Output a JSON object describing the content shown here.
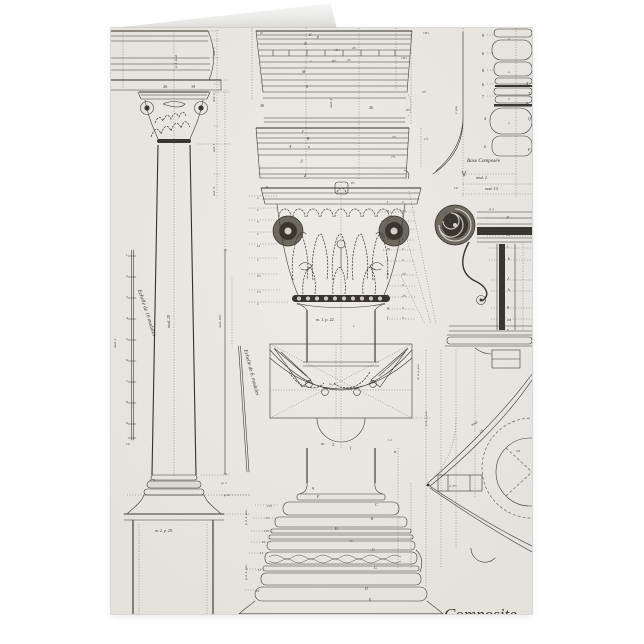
{
  "page": {
    "background": "#ffffff"
  },
  "card": {
    "paper_color": "#e9e7e2",
    "ink_color": "#3e3b33",
    "caption_partial": "Composite",
    "subject": "Composite order engraving plate"
  },
  "engraving": {
    "scale_left": {
      "x": 15,
      "y0": 228,
      "dy": 21,
      "labels": [
        "1",
        "2",
        "3",
        "4",
        "5",
        "6",
        "7",
        "8",
        "9",
        "10"
      ]
    },
    "capital_dim_table": {
      "letter_x": 276,
      "value_x": 291,
      "ys": [
        175,
        184,
        193,
        201,
        212,
        222,
        233,
        247,
        258,
        269,
        281,
        291
      ],
      "rows": [
        [
          "r",
          "2"
        ],
        [
          "q",
          "2½"
        ],
        [
          "p",
          "2"
        ],
        [
          "o",
          "2"
        ],
        [
          "n",
          "2"
        ],
        [
          "m",
          "2"
        ],
        [
          "l",
          "2"
        ],
        [
          "k",
          "2½"
        ],
        [
          "J",
          "2"
        ],
        [
          "h",
          "2½"
        ],
        [
          "g",
          "⅓"
        ],
        [
          "f",
          "½"
        ]
      ]
    },
    "texts": [
      {
        "x": 52,
        "y": 60,
        "t": "26",
        "s": 4.2
      },
      {
        "x": 80,
        "y": 60,
        "t": "19",
        "s": 4.2
      },
      {
        "x": 66,
        "y": 40,
        "t": "p. 4. mod.",
        "r": -90,
        "s": 3.4,
        "i": 1
      },
      {
        "x": 59,
        "y": 300,
        "t": "mod. 20",
        "r": -90,
        "s": 4,
        "i": 1
      },
      {
        "x": 5,
        "y": 320,
        "t": "mod. 2.",
        "r": -90,
        "s": 3.4,
        "i": 1
      },
      {
        "x": 110,
        "y": 300,
        "t": "mod. 16½",
        "r": -90,
        "s": 3.4,
        "i": 1
      },
      {
        "x": 27,
        "y": 262,
        "t": "Echelle de 10 modules",
        "r": 72,
        "s": 5.4,
        "i": 1
      },
      {
        "x": 133,
        "y": 322,
        "t": "Echelle de 6. modules",
        "r": 75,
        "s": 5.4,
        "i": 1
      },
      {
        "x": 104,
        "y": 28,
        "t": "mod. ½",
        "r": -90,
        "s": 3,
        "i": 1
      },
      {
        "x": 104,
        "y": 74,
        "t": "mod. ⅓",
        "r": -90,
        "s": 3,
        "i": 1
      },
      {
        "x": 104,
        "y": 124,
        "t": "mod. 1.",
        "r": -90,
        "s": 3,
        "i": 1
      },
      {
        "x": 104,
        "y": 168,
        "t": "mod. ⅙",
        "r": -90,
        "s": 3,
        "i": 1
      },
      {
        "x": 38,
        "y": 453,
        "t": "m. 3",
        "s": 3.4,
        "i": 1
      },
      {
        "x": 44,
        "y": 504,
        "t": "m. 2. p. 29.",
        "s": 4,
        "i": 1
      },
      {
        "x": 110,
        "y": 456,
        "t": "m. 1",
        "s": 3.4,
        "i": 1
      },
      {
        "x": 113,
        "y": 468,
        "t": "p. 3.",
        "s": 3.4,
        "i": 1
      },
      {
        "x": 136,
        "y": 497,
        "t": "p. d. 4. pou.",
        "r": -90,
        "s": 3.3,
        "i": 1
      },
      {
        "x": 136,
        "y": 552,
        "t": "g. d. 4. pou.",
        "r": -90,
        "s": 3.3,
        "i": 1
      },
      {
        "x": 149,
        "y": 6,
        "t": "10",
        "s": 3
      },
      {
        "x": 198,
        "y": 8,
        "t": "C",
        "s": 4,
        "i": 1
      },
      {
        "x": 206,
        "y": 10,
        "t": "p",
        "s": 4,
        "i": 1
      },
      {
        "x": 193,
        "y": 17,
        "t": "N",
        "s": 3.8,
        "i": 1
      },
      {
        "x": 223,
        "y": 23,
        "t": "12½",
        "s": 3.4
      },
      {
        "x": 241,
        "y": 21,
        "t": "20",
        "s": 3.4
      },
      {
        "x": 199,
        "y": 34,
        "t": "1",
        "s": 3.4
      },
      {
        "x": 221,
        "y": 34,
        "t": "8½",
        "s": 3.4
      },
      {
        "x": 236,
        "y": 33,
        "t": "23",
        "s": 3.4
      },
      {
        "x": 290,
        "y": 31,
        "t": "14½",
        "s": 3.4
      },
      {
        "x": 312,
        "y": 6,
        "t": "10½",
        "s": 3.4
      },
      {
        "x": 191,
        "y": 45,
        "t": "M",
        "s": 3.8,
        "i": 1
      },
      {
        "x": 195,
        "y": 60,
        "t": "S",
        "s": 4,
        "i": 1
      },
      {
        "x": 149,
        "y": 79,
        "t": "30",
        "s": 4
      },
      {
        "x": 221,
        "y": 80,
        "t": "mod. 4",
        "r": -90,
        "s": 3.4,
        "i": 1
      },
      {
        "x": 258,
        "y": 81,
        "t": "26",
        "s": 4
      },
      {
        "x": 295,
        "y": 83,
        "t": "8½",
        "s": 3.4
      },
      {
        "x": 311,
        "y": 65,
        "t": "2½",
        "s": 3.4
      },
      {
        "x": 191,
        "y": 104,
        "t": "y",
        "s": 4,
        "i": 1
      },
      {
        "x": 196,
        "y": 112,
        "t": "B",
        "s": 3.6,
        "i": 1
      },
      {
        "x": 197,
        "y": 120,
        "t": "u",
        "s": 3.6,
        "i": 1
      },
      {
        "x": 178,
        "y": 120,
        "t": "X",
        "s": 4,
        "i": 1
      },
      {
        "x": 190,
        "y": 134,
        "t": "y",
        "s": 5,
        "i": 1
      },
      {
        "x": 193,
        "y": 149,
        "t": "Z",
        "s": 4,
        "i": 1
      },
      {
        "x": 281,
        "y": 110,
        "t": "2½",
        "s": 3.4
      },
      {
        "x": 280,
        "y": 130,
        "t": "7½",
        "s": 3.4
      },
      {
        "x": 313,
        "y": 112,
        "t": "1½",
        "s": 3.4
      },
      {
        "x": 146,
        "y": 171,
        "t": "2",
        "s": 3
      },
      {
        "x": 146,
        "y": 183,
        "t": "2",
        "s": 3
      },
      {
        "x": 146,
        "y": 195,
        "t": "3",
        "s": 3
      },
      {
        "x": 146,
        "y": 207,
        "t": "2",
        "s": 3
      },
      {
        "x": 146,
        "y": 219,
        "t": "12",
        "s": 3
      },
      {
        "x": 146,
        "y": 233,
        "t": "2",
        "s": 3
      },
      {
        "x": 146,
        "y": 249,
        "t": "2½",
        "s": 3
      },
      {
        "x": 146,
        "y": 265,
        "t": "1½",
        "s": 3
      },
      {
        "x": 146,
        "y": 277,
        "t": "2",
        "s": 3
      },
      {
        "x": 155,
        "y": 160,
        "t": "u",
        "s": 4,
        "i": 1
      },
      {
        "x": 240,
        "y": 156,
        "t": "9½",
        "s": 3
      },
      {
        "x": 205,
        "y": 293,
        "t": "m. 1.  p. 22.",
        "s": 4.2,
        "i": 1
      },
      {
        "x": 242,
        "y": 299,
        "t": "e",
        "s": 3.4,
        "i": 1
      },
      {
        "x": 218,
        "y": 357,
        "t": "m. 2",
        "s": 3.4,
        "i": 1
      },
      {
        "x": 210,
        "y": 417,
        "t": "m.",
        "s": 4,
        "i": 1
      },
      {
        "x": 221,
        "y": 418,
        "t": "2.",
        "s": 4
      },
      {
        "x": 239,
        "y": 421,
        "t": "f",
        "s": 4,
        "i": 1
      },
      {
        "x": 277,
        "y": 413,
        "t": "1 2",
        "s": 3
      },
      {
        "x": 283,
        "y": 425,
        "t": "B",
        "s": 3.4,
        "i": 1
      },
      {
        "x": 201,
        "y": 461,
        "t": "q",
        "s": 4,
        "i": 1
      },
      {
        "x": 206,
        "y": 470,
        "t": "F",
        "s": 4,
        "i": 1
      },
      {
        "x": 264,
        "y": 478,
        "t": "C",
        "s": 3.8,
        "i": 1
      },
      {
        "x": 260,
        "y": 492,
        "t": "B",
        "s": 3.6,
        "i": 1
      },
      {
        "x": 224,
        "y": 502,
        "t": "H",
        "s": 3.8,
        "i": 1
      },
      {
        "x": 238,
        "y": 514,
        "t": "13",
        "s": 3.4
      },
      {
        "x": 261,
        "y": 523,
        "t": "G",
        "s": 3.8,
        "i": 1
      },
      {
        "x": 263,
        "y": 541,
        "t": "G",
        "s": 3.8,
        "i": 1
      },
      {
        "x": 254,
        "y": 562,
        "t": "D",
        "s": 3.8,
        "i": 1
      },
      {
        "x": 258,
        "y": 573,
        "t": "E",
        "s": 3.8,
        "i": 1
      },
      {
        "x": 156,
        "y": 479,
        "t": "12½",
        "s": 2.9
      },
      {
        "x": 155,
        "y": 491,
        "t": "15",
        "s": 2.9
      },
      {
        "x": 153,
        "y": 504,
        "t": "11½",
        "s": 2.9
      },
      {
        "x": 151,
        "y": 515,
        "t": "16",
        "s": 2.9
      },
      {
        "x": 149,
        "y": 526,
        "t": "11",
        "s": 2.9
      },
      {
        "x": 147,
        "y": 543,
        "t": "12",
        "s": 2.9
      },
      {
        "x": 145,
        "y": 564,
        "t": "16",
        "s": 2.9
      },
      {
        "x": 371,
        "y": 9,
        "t": "8",
        "s": 4.2
      },
      {
        "x": 371,
        "y": 27,
        "t": "6",
        "s": 4.2
      },
      {
        "x": 371,
        "y": 44,
        "t": "8",
        "s": 4.2
      },
      {
        "x": 371,
        "y": 58,
        "t": "6",
        "s": 4.2
      },
      {
        "x": 371,
        "y": 70,
        "t": "7",
        "s": 4.2
      },
      {
        "x": 373,
        "y": 92,
        "t": "4",
        "s": 4,
        "i": 1
      },
      {
        "x": 373,
        "y": 120,
        "t": "6",
        "s": 4,
        "i": 1
      },
      {
        "x": 397,
        "y": 12,
        "t": "u",
        "s": 3,
        "i": 1
      },
      {
        "x": 397,
        "y": 45,
        "t": "u",
        "s": 3,
        "i": 1
      },
      {
        "x": 397,
        "y": 72,
        "t": "u",
        "s": 3,
        "i": 1
      },
      {
        "x": 397,
        "y": 96,
        "t": "u",
        "s": 3,
        "i": 1
      },
      {
        "x": 415,
        "y": 57,
        "t": "X",
        "s": 4,
        "i": 1
      },
      {
        "x": 417,
        "y": 67,
        "t": "T",
        "s": 4,
        "i": 1
      },
      {
        "x": 415,
        "y": 77,
        "t": "R",
        "s": 4,
        "i": 1
      },
      {
        "x": 417,
        "y": 92,
        "t": "Q",
        "s": 4,
        "i": 1
      },
      {
        "x": 417,
        "y": 123,
        "t": "F",
        "s": 4,
        "i": 1
      },
      {
        "x": 346,
        "y": 86,
        "t": "1. pou",
        "r": -90,
        "s": 3.2,
        "i": 1
      },
      {
        "x": 356,
        "y": 134,
        "t": "Base Composée",
        "s": 5.2,
        "i": 1
      },
      {
        "x": 365,
        "y": 151,
        "t": "mod. 2.",
        "s": 4,
        "i": 1
      },
      {
        "x": 343,
        "y": 161,
        "t": "16",
        "s": 3.4
      },
      {
        "x": 374,
        "y": 162,
        "t": "mod. 1½",
        "s": 3.8,
        "i": 1
      },
      {
        "x": 378,
        "y": 182,
        "t": "q. 4",
        "s": 3.2,
        "i": 1
      },
      {
        "x": 396,
        "y": 190,
        "t": "p",
        "s": 4,
        "i": 1
      },
      {
        "x": 396,
        "y": 208,
        "t": "m",
        "s": 4,
        "i": 1
      },
      {
        "x": 396,
        "y": 220,
        "t": "l",
        "s": 4,
        "i": 1
      },
      {
        "x": 397,
        "y": 232,
        "t": "k",
        "s": 4,
        "i": 1
      },
      {
        "x": 396,
        "y": 252,
        "t": "J",
        "s": 4,
        "i": 1
      },
      {
        "x": 397,
        "y": 263,
        "t": "h",
        "s": 4,
        "i": 1
      },
      {
        "x": 396,
        "y": 280,
        "t": "g",
        "s": 4,
        "i": 1
      },
      {
        "x": 396,
        "y": 293,
        "t": "2.6",
        "s": 3.3
      },
      {
        "x": 396,
        "y": 303,
        "t": "e",
        "s": 4,
        "i": 1
      },
      {
        "x": 308,
        "y": 352,
        "t": "m. d. g. pou",
        "r": -90,
        "s": 3.3,
        "i": 1
      },
      {
        "x": 316,
        "y": 398,
        "t": "p. d. y. pou",
        "r": -90,
        "s": 3.3,
        "i": 1
      },
      {
        "x": 361,
        "y": 398,
        "t": "mod.",
        "r": -30,
        "s": 3.5,
        "i": 1
      },
      {
        "x": 369,
        "y": 405,
        "t": "2 6",
        "r": -30,
        "s": 3.3
      },
      {
        "x": 405,
        "y": 424,
        "t": "2.6",
        "s": 3.3
      },
      {
        "x": 338,
        "y": 459,
        "t": "2. 2½",
        "s": 3.3
      },
      {
        "x": 333,
        "y": 592,
        "t": "Composite",
        "s": 17,
        "i": 1,
        "n": "caption-composite"
      }
    ]
  }
}
